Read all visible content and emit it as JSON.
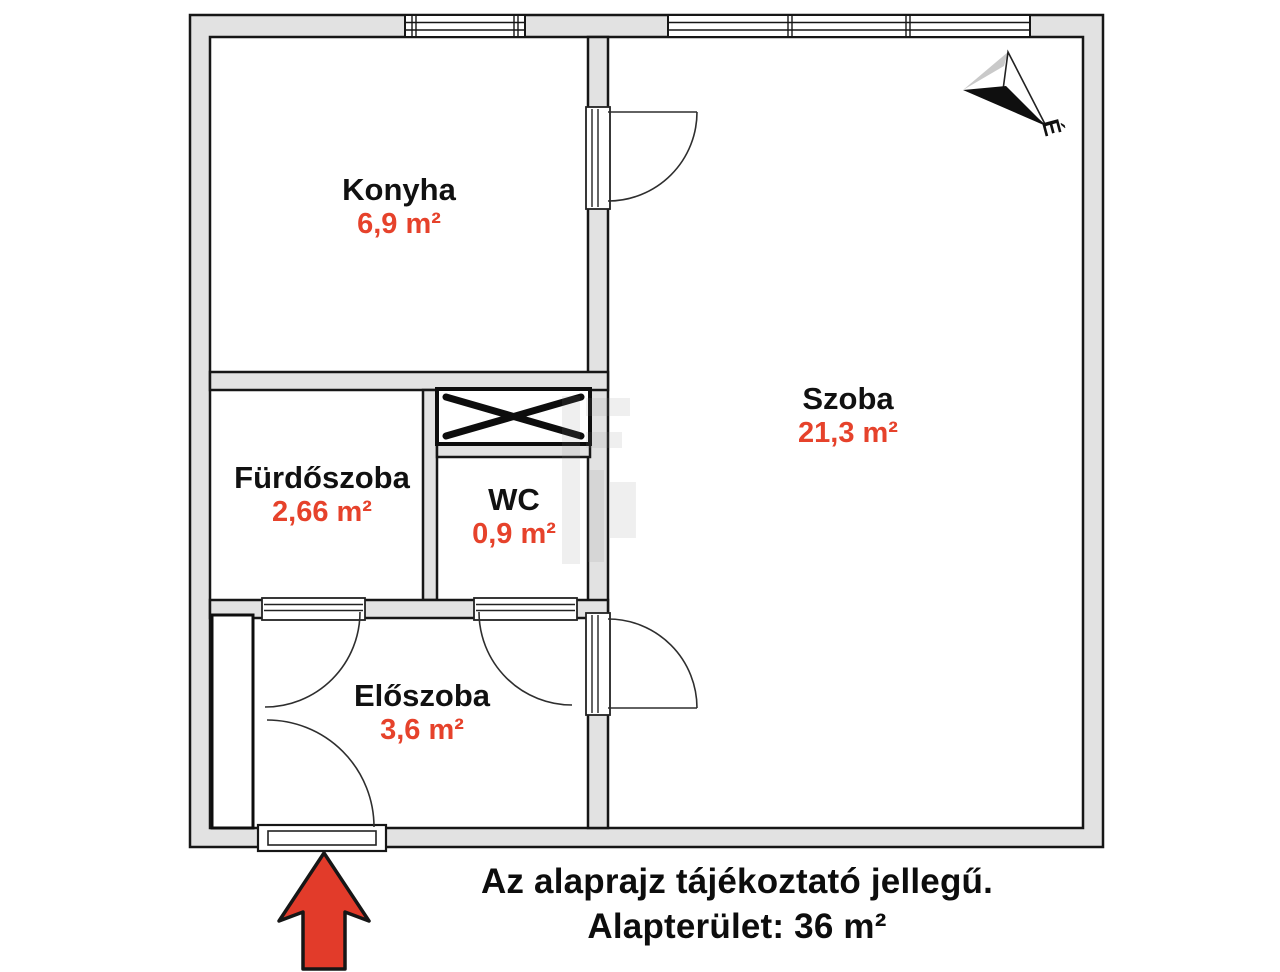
{
  "floor_plan": {
    "rooms": [
      {
        "name": "Konyha",
        "area": "6,9 m²"
      },
      {
        "name": "Fürdőszoba",
        "area": "2,66 m²"
      },
      {
        "name": "WC",
        "area": "0,9 m²"
      },
      {
        "name": "Előszoba",
        "area": "3,6 m²"
      },
      {
        "name": "Szoba",
        "area": "21,3 m²"
      }
    ],
    "compass": {
      "label": "É"
    },
    "footer": {
      "line1": "Az alaprajz tájékoztató jellegű.",
      "line2": "Alapterület: 36 m²"
    },
    "colors": {
      "label_red": "#E6422B",
      "arrow_red": "#E23B2A",
      "wall_gray": "#E2E2E2",
      "line_black": "#161616"
    }
  }
}
